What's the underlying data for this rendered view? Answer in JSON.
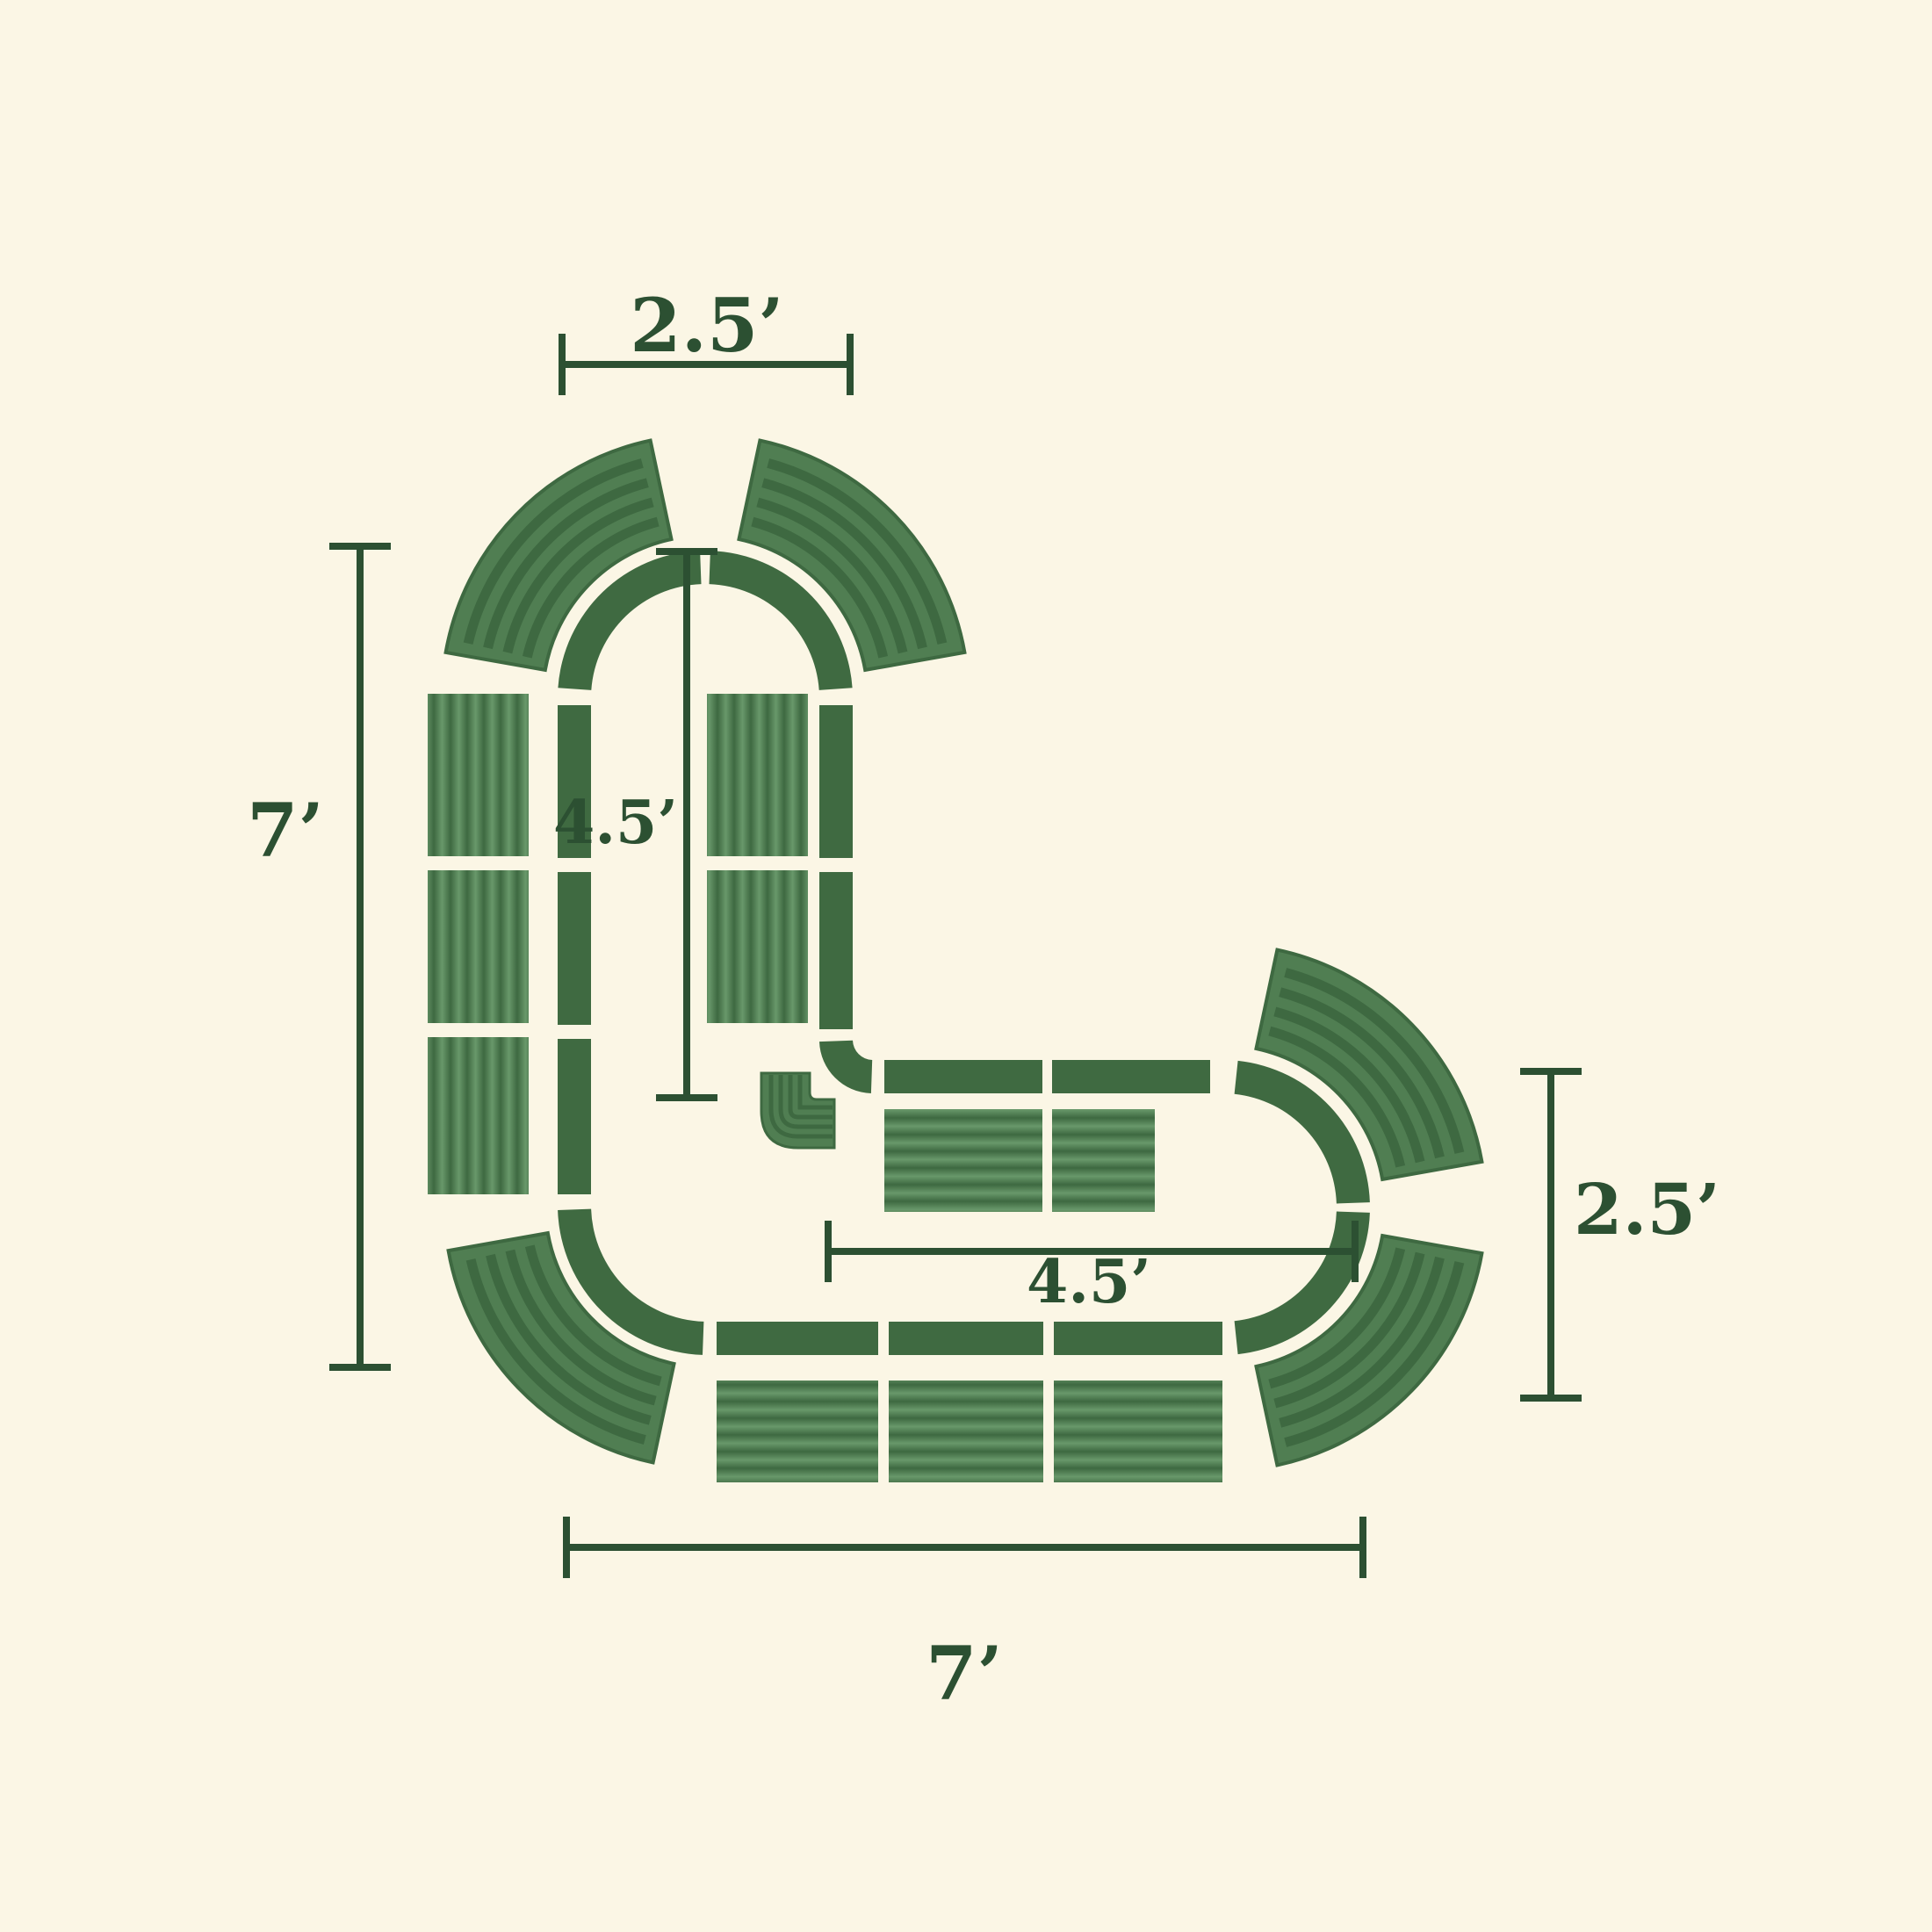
{
  "figure": {
    "type": "diagram",
    "subject": "L-shaped modular raised garden bed, top-down layout with dimensions",
    "straight_side_panels": 10,
    "curved_side_panels": 5,
    "inner_corner_panels": 1,
    "wall_segments": 16
  },
  "dimensions": {
    "top_width": {
      "label": "2.5’"
    },
    "left_height": {
      "label": "7’"
    },
    "inner_height": {
      "label": "4.5’"
    },
    "inner_length": {
      "label": "4.5’"
    },
    "right_width": {
      "label": "2.5’"
    },
    "bottom_length": {
      "label": "7’"
    }
  },
  "colors": {
    "background": "#FBF6E5",
    "wall": "#3F6A41",
    "panel_dark": "#3E6941",
    "panel_light": "#68986A",
    "panel_curved_base": "#507E52",
    "dimension": "#2C5032"
  }
}
